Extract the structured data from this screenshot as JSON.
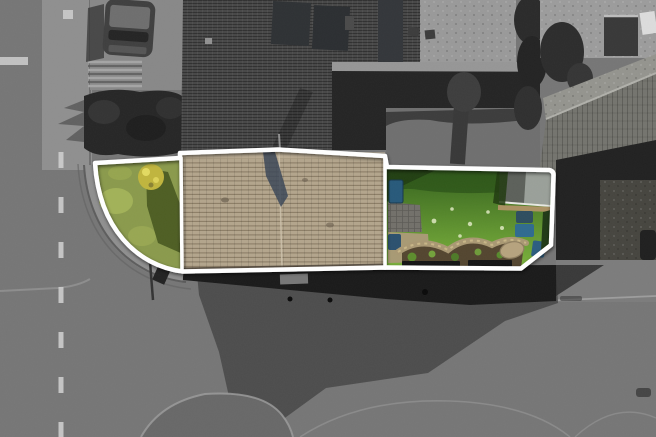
{
  "scene": {
    "kind": "aerial-drone-photograph",
    "subject": "corner property highlighted in colour inside a white plot boundary; all surroundings desaturated to grayscale",
    "regions": {
      "left": "road with dashed centre line and pavement",
      "top_left": "driveway with parked car, steps and hedge",
      "center": "dark tiled house roof with solar panels",
      "property": "front lawn on street corner, tan tiled roof, rear garden with shed, bins and flower bed",
      "right": "neighbouring pitched roof and yard",
      "bottom": "road junction in building shadow with kerb arcs and traffic island"
    }
  },
  "colors": {
    "road": "#767676",
    "pavement": "#8f8f8f",
    "curb": "#585858",
    "centerline": "#d2d2d2",
    "dark_roof": "#474747",
    "solar_panel": "#2e3134",
    "hedge": "#262626",
    "gray_lawn": "#6f6f6f",
    "patio_gray": "#999999",
    "concrete": "#9c9c9c",
    "neighbour_roof_light": "#94948e",
    "neighbour_roof_dark": "#74746e",
    "wall_dark": "#1a1a1a",
    "shadow": "#4d4d4d",
    "island": "#686868",
    "boundary": "#ffffff",
    "left_lawn": "#8a9a4c",
    "lawn_highlight": "#a9b95c",
    "lawn_shadow": "#47581f",
    "shrub_yellow": "#c0b53d",
    "tan_roof": "#b3a58c",
    "roof_stain": "#3b4757",
    "garden_lawn_top": "#33601c",
    "garden_lawn_bottom": "#7cb33c",
    "flower_dot": "#dfe9c2",
    "patio": "#72706a",
    "gravel": "#a89a74",
    "soil": "#53452f",
    "stone_border": "#a99873",
    "boulder": "#b6a37e",
    "plant_green": "#5d8d2d",
    "shed_dark": "#5c605a",
    "shed_light": "#9aa099",
    "wood_strip": "#ab9162",
    "bin_dark": "#2d4d5f",
    "bin_blue": "#2f6b8f",
    "bin_mid": "#2b5d80",
    "water_butt": "#27597a",
    "edging": "#141414",
    "car_body": "#3f3f3f",
    "car_roof": "#6e6e6e"
  }
}
